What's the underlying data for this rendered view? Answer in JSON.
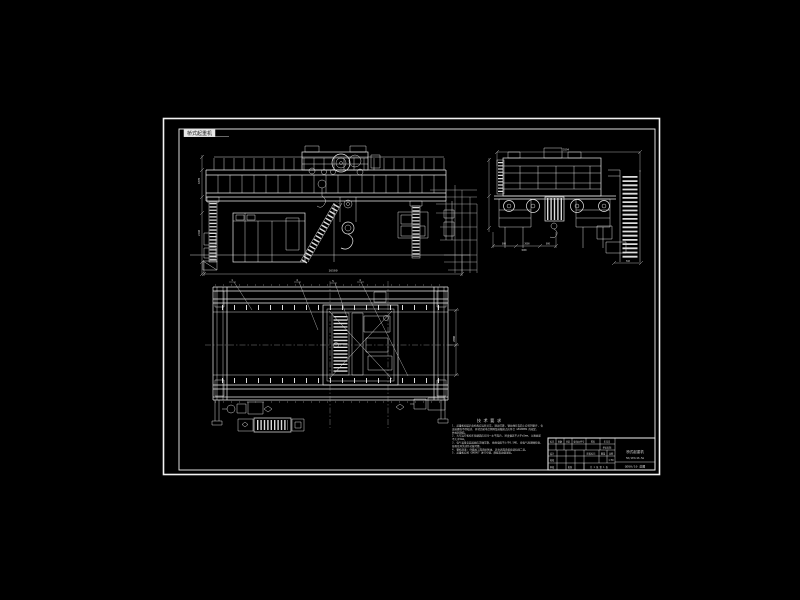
{
  "meta": {
    "background": "#000000",
    "line_color": "#e9e9e9",
    "dim_line_color": "#b9b9b9"
  },
  "sheet": {
    "corner_label": "桥式起重机"
  },
  "callouts": {
    "c1": "1",
    "c2": "4",
    "c3": "5",
    "c4": "4"
  },
  "dims": {
    "span": "16500",
    "front_left_a": "1870",
    "front_left_b": "2240",
    "end_top": "5594",
    "end_b1": "800",
    "end_b2": "2000",
    "end_b3": "800",
    "end_b4": "3600",
    "end_ladder": "560",
    "plan_right": "2000"
  },
  "notes": {
    "title": "技 术 要 求",
    "lines": [
      "1. 起重机组装后各机构应运转灵活, 制动可靠, 钢丝绳在卷筒上应排列整齐, 各",
      "   连接螺栓不得松动, 开式齿轮啮合侧隙及接触斑点应符合 GB10089 的规定,",
      "   并加润滑脂。",
      "2. 大车运行机构车轮踏面应在同一水平面内, 跨度偏差不大于±5mm, 对角线差",
      "   不大于5mm。",
      "3. 电气设备安装接线应正确可靠, 绝缘电阻不小于0.5MΩ, 按电气原理图检查,",
      "   各限位开关动作灵敏可靠。",
      "4. 整机涂漆: 外露加工面涂防锈油, 其余表面涂黄色调和漆二道。",
      "5. 起重机应按 GB6067 进行空载、静载及动载试验。"
    ]
  },
  "title_block": {
    "labels": {
      "mark": "标记",
      "count": "处数",
      "zone": "分区",
      "doc": "更改文件号",
      "sign": "签名",
      "date": "年月日",
      "org": "单位名称",
      "design": "设计",
      "check": "校核",
      "review": "审核",
      "approve": "批准",
      "stage": "阶段标记",
      "weight": "重量",
      "scale": "比例",
      "sheets": "共 1 张 第 1 张"
    },
    "values": {
      "scale": "1:50",
      "name_line1": "桥式起重机",
      "name_line2": "50/10t×16.5m",
      "dwg_no": "QD50/10 总图"
    }
  }
}
